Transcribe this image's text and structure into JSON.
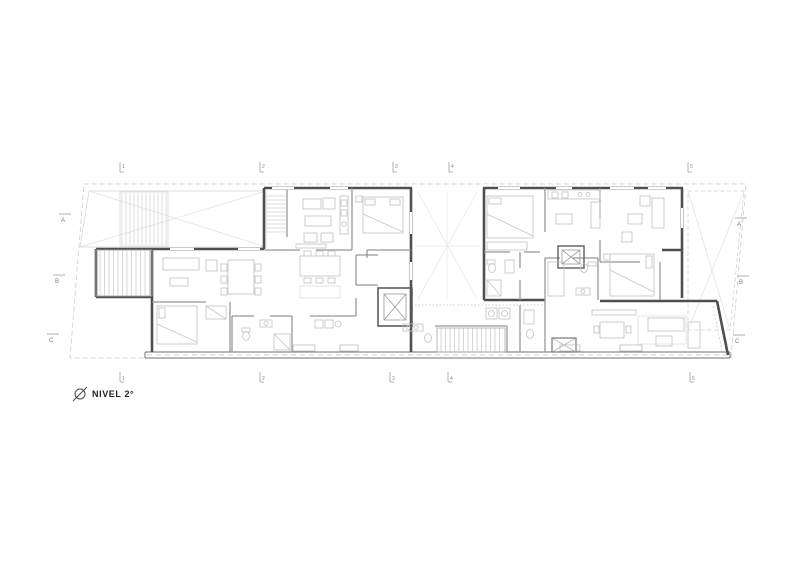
{
  "title_block": {
    "label": "NIVEL 2°",
    "symbol": "diameter-level-marker"
  },
  "grid": {
    "top": [
      {
        "label": "1"
      },
      {
        "label": "2"
      },
      {
        "label": "3"
      },
      {
        "label": "4"
      },
      {
        "label": "5"
      }
    ],
    "bottom": [
      {
        "label": "1"
      },
      {
        "label": "2"
      },
      {
        "label": "3"
      },
      {
        "label": "4"
      },
      {
        "label": "5"
      }
    ],
    "left": [
      {
        "label": "A"
      },
      {
        "label": "B"
      },
      {
        "label": "C"
      }
    ],
    "right": [
      {
        "label": "A"
      },
      {
        "label": "B"
      },
      {
        "label": "C"
      }
    ]
  },
  "colors": {
    "background": "#ffffff",
    "wall": "#4f4f4f",
    "partition": "#979797",
    "furniture": "#c7c7c7",
    "hatch": "#bfbfbf",
    "boundary": "#cdcdcd",
    "faint": "#e3e3e3",
    "title_text": "#222222",
    "grid_text": "#8c8c8c"
  },
  "plan": {
    "type": "architectural-floor-plan",
    "level_label": "NIVEL 2°",
    "elements": [
      "site-boundary",
      "terrace-left-void",
      "terrace-right-void",
      "central-courtyard",
      "apartment-block-left",
      "apartment-block-right",
      "exterior-stair",
      "interior-stairs",
      "elevator-shaft-left",
      "elevator-shaft-right",
      "south-facade-band"
    ]
  }
}
